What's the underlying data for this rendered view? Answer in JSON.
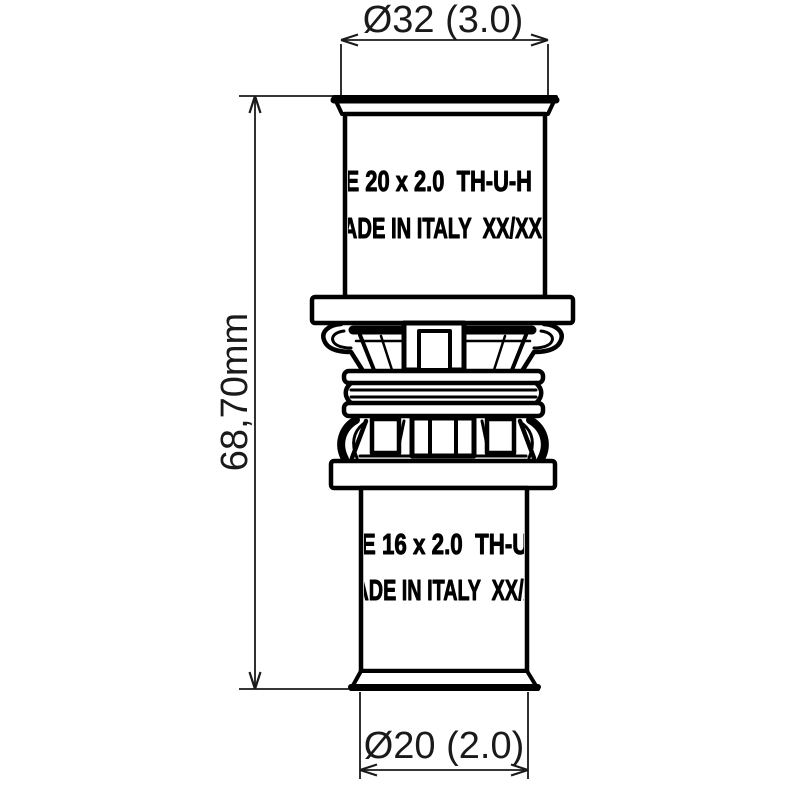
{
  "dimensions": {
    "top": {
      "label": "Ø32 (3.0)"
    },
    "left": {
      "label": "68,70mm"
    },
    "bottom": {
      "label": "Ø20 (2.0)"
    }
  },
  "markings": {
    "upper_sleeve": {
      "line1": "PE 20 x 2.0  TH-U-H",
      "line2": "MADE IN ITALY  XX/XX"
    },
    "lower_sleeve": {
      "line1": "PE 16 x 2.0  TH-U-H",
      "line2": "MADE IN ITALY  XX/XX"
    }
  },
  "colors": {
    "line": "#000000",
    "dimension_line": "#1a1a1a",
    "background": "#ffffff"
  }
}
